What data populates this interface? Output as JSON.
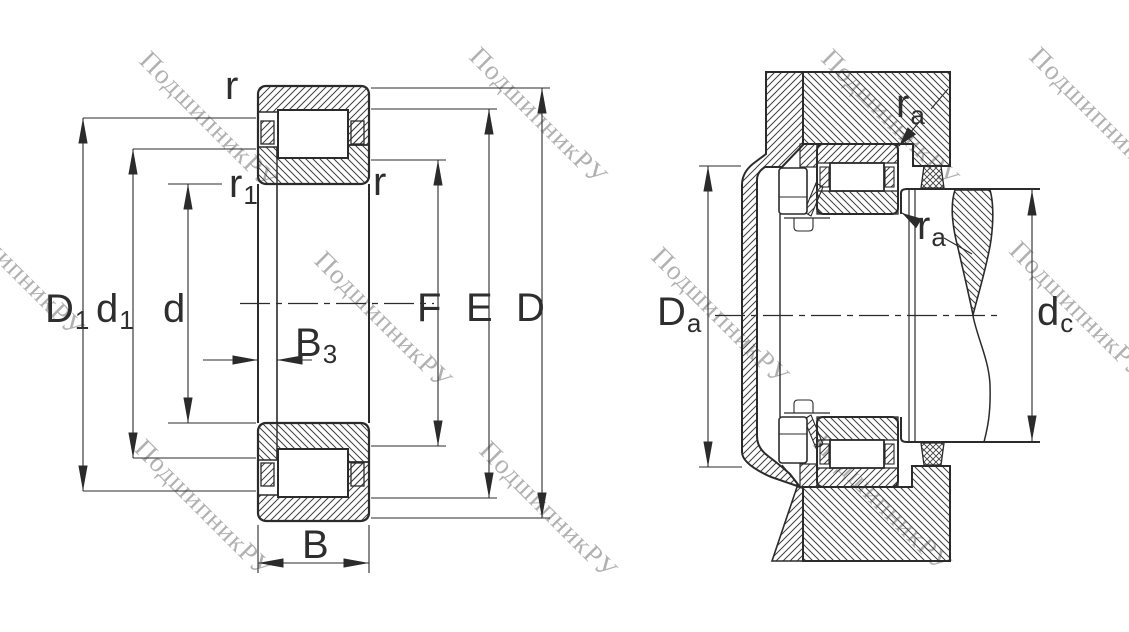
{
  "watermark": {
    "text": "ПодшипникРУ"
  },
  "colors": {
    "line": "#2b2b2b",
    "hatch": "#3f3f3f",
    "label": "#2e2e2e",
    "watermark": "#9c9c9c",
    "background": "#ffffff"
  },
  "left_view": {
    "title": "cylindrical roller bearing cross-section with boundary dimensions",
    "labels": {
      "D1": {
        "main": "D",
        "sub": "1"
      },
      "d1": {
        "main": "d",
        "sub": "1"
      },
      "d": {
        "main": "d",
        "sub": ""
      },
      "F": {
        "main": "F",
        "sub": ""
      },
      "E": {
        "main": "E",
        "sub": ""
      },
      "D": {
        "main": "D",
        "sub": ""
      },
      "B3": {
        "main": "B",
        "sub": "3"
      },
      "B": {
        "main": "B",
        "sub": ""
      },
      "r_outer": {
        "main": "r",
        "sub": ""
      },
      "r_inner": {
        "main": "r",
        "sub": ""
      },
      "r1": {
        "main": "r",
        "sub": "1"
      }
    }
  },
  "right_view": {
    "title": "mounted bearing arrangement with abutment dimensions",
    "labels": {
      "Da": {
        "main": "D",
        "sub": "a"
      },
      "dc": {
        "main": "d",
        "sub": "c"
      },
      "ra_top": {
        "main": "r",
        "sub": "a"
      },
      "ra_bottom": {
        "main": "r",
        "sub": "a"
      }
    }
  }
}
